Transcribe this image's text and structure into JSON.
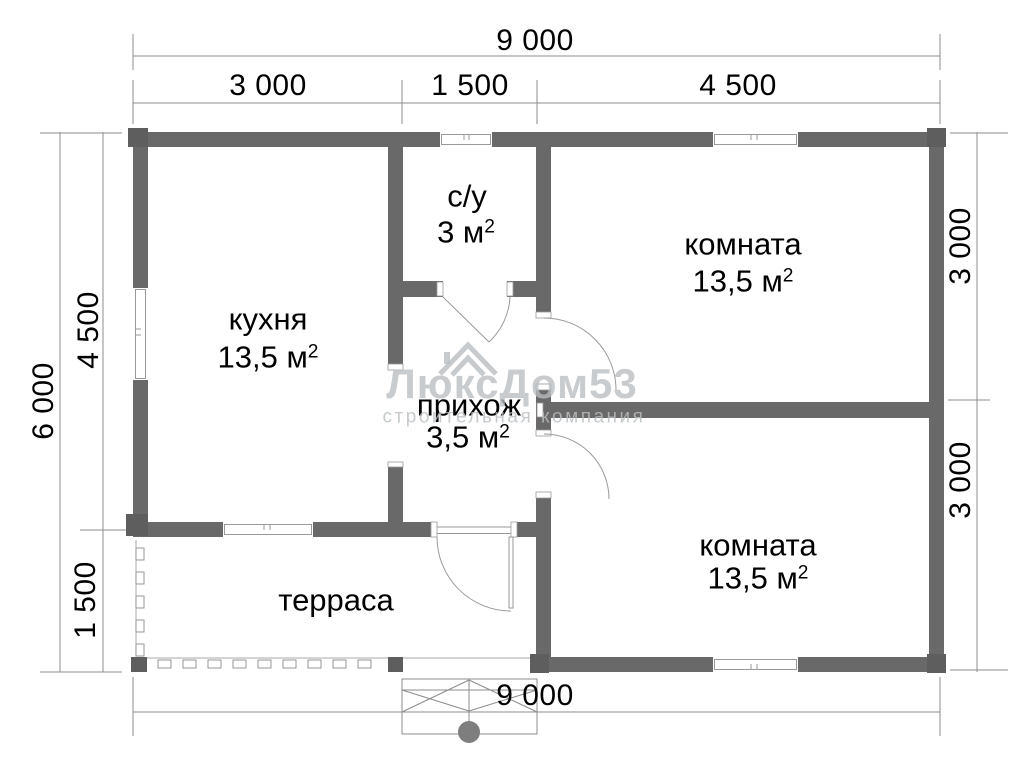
{
  "plan": {
    "title": "floor plan 9000 x 6000",
    "rooms": {
      "kitchen": {
        "label": "кухня",
        "area": "13,5 м",
        "area_sup": "2"
      },
      "bathroom": {
        "label": "с/у",
        "area": "3 м",
        "area_sup": "2"
      },
      "room_top": {
        "label": "комната",
        "area": "13,5 м",
        "area_sup": "2"
      },
      "hallway": {
        "label": "прихож",
        "area": "3,5 м",
        "area_sup": "2"
      },
      "room_bottom": {
        "label": "комната",
        "area": "13,5 м",
        "area_sup": "2"
      },
      "terrace": {
        "label": "терраса"
      }
    },
    "dimensions": {
      "top_total": "9 000",
      "top_seg_left": "3 000",
      "top_seg_mid": "1 500",
      "top_seg_right": "4 500",
      "left_total": "6 000",
      "left_seg_top": "4 500",
      "left_seg_bottom": "1 500",
      "right_seg_top": "3 000",
      "right_seg_bottom": "3 000",
      "bottom_total": "9 000"
    },
    "watermark": {
      "logo_icon": "roof-house-icon",
      "title": "ЛюксДом53",
      "subtitle": "строительная компания"
    },
    "colors": {
      "wall": "#696969",
      "corner_block": "#5e5e5e",
      "thin_line": "#9a9a9a",
      "dim_line": "#8c8c8c",
      "text": "#000000",
      "watermark": "rgba(185,190,193,0.78)"
    }
  }
}
